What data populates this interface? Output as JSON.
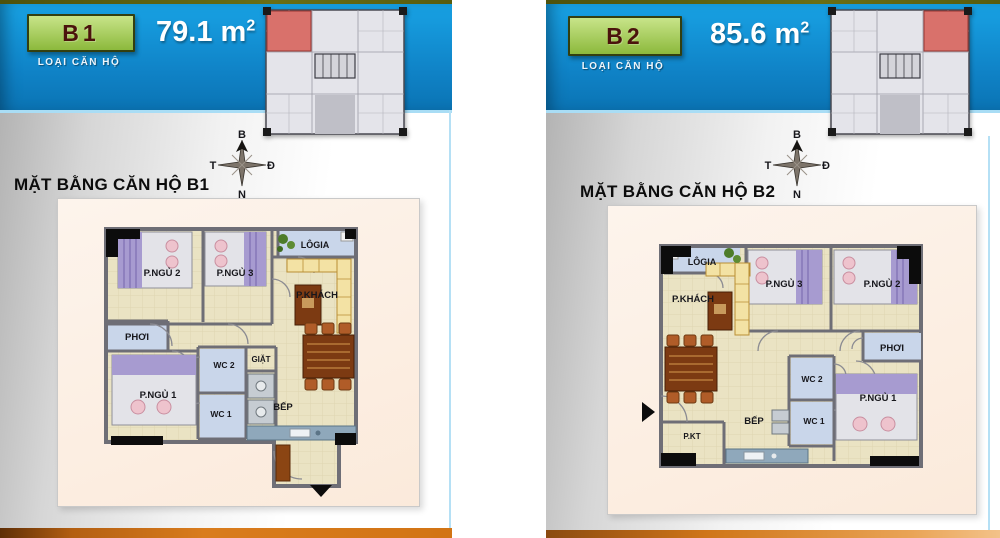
{
  "panels": [
    {
      "unit": "B1",
      "type_caption": "LOẠI CĂN HỘ",
      "area_value": "79.1",
      "area_unit": "m",
      "area_sup": "2",
      "plan_title": "MẶT BẰNG CĂN HỘ B1",
      "highlight_position": "top-left",
      "compass": {
        "north": "B",
        "west": "T",
        "east": "Đ",
        "south": "N"
      },
      "rooms": {
        "bedroom2": "P.NGỦ 2",
        "bedroom3": "P.NGỦ 3",
        "loggia": "LÔGIA",
        "living": "P.KHÁCH",
        "drying": "PHƠI",
        "wc2": "WC 2",
        "laundry": "GIẶT",
        "bedroom1": "P.NGỦ 1",
        "wc1": "WC 1",
        "kitchen": "BẾP"
      }
    },
    {
      "unit": "B2",
      "type_caption": "LOẠI CĂN HỘ",
      "area_value": "85.6",
      "area_unit": "m",
      "area_sup": "2",
      "plan_title": "MẶT BẰNG CĂN HỘ B2",
      "highlight_position": "top-right",
      "compass": {
        "north": "B",
        "west": "T",
        "east": "Đ",
        "south": "N"
      },
      "rooms": {
        "loggia": "LÔGIA",
        "living": "P.KHÁCH",
        "bedroom3": "P.NGỦ 3",
        "bedroom2": "P.NGỦ 2",
        "drying": "PHƠI",
        "wc2": "WC 2",
        "wc1": "WC 1",
        "bedroom1": "P.NGỦ 1",
        "kitchen": "BẾP",
        "tech": "P.KT"
      }
    }
  ],
  "colors": {
    "header_blue": "#0f82c6",
    "badge_green": "#9cc44e",
    "accent_orange": "#d97c1d",
    "highlight_red": "#d9716b",
    "olive_strip": "#565a0e",
    "wet_room_blue": "#c9d6ea",
    "floor_beige": "#eae3c3"
  }
}
